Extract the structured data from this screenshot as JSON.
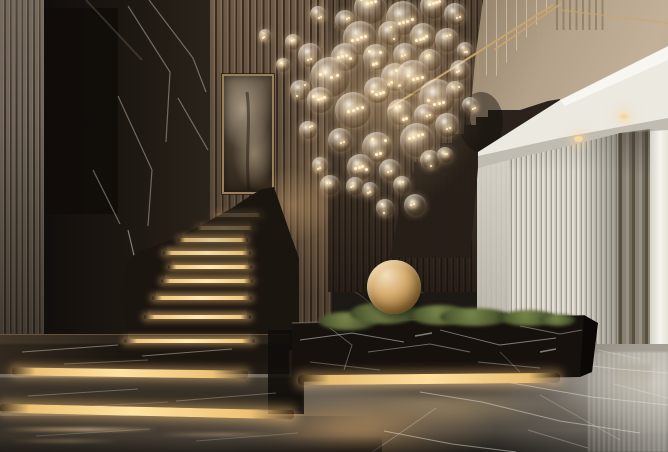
{
  "meta": {
    "description": "Luxury villa entrance hall: black marble feature wall, illuminated black-marble staircase with warm LED step nosings and glass balustrade, glass-bubble chandelier, beige upper landing with brass handrail, white curved soffit with recessed lights, white fluted wall, taupe curtain, indoor tree in a black marble planter with brass spheres and moss, polished grey marble floor. Semi-transparent real-estate watermark over the centre."
  },
  "watermark": {
    "number": "25",
    "brand": "SPACES",
    "tagline": "real estate",
    "color": "rgba(231,228,219,0.6)"
  },
  "palette": {
    "brass": "#c9a66a",
    "step_glow": "#ffe3a0",
    "dark_marble": "#1b1510",
    "wood_slat": "#7b6651",
    "beige_wall": "#b3a189",
    "soffit_white": "#ece9e1",
    "fluted_wall": "#d6d2c7",
    "curtain": "#857c6f",
    "floor_grey": "#6e6860",
    "foliage_green": "#64743e",
    "gold_sphere": "#d9b174"
  },
  "scene": {
    "chandelier": {
      "bubbles": [
        [
          370,
          8,
          16
        ],
        [
          403,
          18,
          17
        ],
        [
          433,
          6,
          13
        ],
        [
          455,
          14,
          11
        ],
        [
          345,
          20,
          10
        ],
        [
          318,
          14,
          8
        ],
        [
          360,
          38,
          17
        ],
        [
          390,
          33,
          12
        ],
        [
          423,
          36,
          13
        ],
        [
          447,
          40,
          12
        ],
        [
          465,
          50,
          8
        ],
        [
          293,
          42,
          8
        ],
        [
          310,
          55,
          12
        ],
        [
          345,
          57,
          14
        ],
        [
          376,
          57,
          13
        ],
        [
          405,
          55,
          12
        ],
        [
          430,
          60,
          11
        ],
        [
          460,
          70,
          10
        ],
        [
          283,
          65,
          7
        ],
        [
          265,
          35,
          6
        ],
        [
          330,
          77,
          20
        ],
        [
          395,
          77,
          14
        ],
        [
          413,
          77,
          17
        ],
        [
          300,
          90,
          10
        ],
        [
          377,
          90,
          13
        ],
        [
          455,
          90,
          9
        ],
        [
          437,
          97,
          18
        ],
        [
          320,
          100,
          13
        ],
        [
          470,
          105,
          8
        ],
        [
          353,
          110,
          18
        ],
        [
          400,
          112,
          13
        ],
        [
          425,
          115,
          11
        ],
        [
          308,
          130,
          9
        ],
        [
          340,
          140,
          12
        ],
        [
          417,
          140,
          17
        ],
        [
          447,
          125,
          12
        ],
        [
          445,
          155,
          8
        ],
        [
          377,
          147,
          15
        ],
        [
          360,
          167,
          13
        ],
        [
          430,
          160,
          10
        ],
        [
          390,
          170,
          11
        ],
        [
          402,
          185,
          9
        ],
        [
          370,
          190,
          8
        ],
        [
          330,
          185,
          10
        ],
        [
          320,
          165,
          8
        ],
        [
          415,
          205,
          11
        ],
        [
          385,
          208,
          9
        ],
        [
          355,
          186,
          9
        ]
      ]
    },
    "staircase": {
      "step_lights": [
        [
          212,
          50,
          215,
          0.22
        ],
        [
          196,
          58,
          228,
          0.35
        ],
        [
          178,
          70,
          240,
          0.85
        ],
        [
          163,
          88,
          253,
          0.95
        ],
        [
          168,
          84,
          267,
          1
        ],
        [
          161,
          92,
          281,
          1
        ],
        [
          152,
          100,
          298,
          1
        ],
        [
          144,
          107,
          317,
          1
        ],
        [
          124,
          131,
          341,
          1
        ]
      ]
    },
    "tree": {
      "foliage": [
        [
          328,
          200,
          56,
          46,
          0.9
        ],
        [
          362,
          178,
          64,
          50,
          0.92
        ],
        [
          402,
          170,
          58,
          44,
          0.9
        ],
        [
          355,
          225,
          70,
          55,
          0.95
        ],
        [
          398,
          215,
          66,
          52,
          0.95
        ],
        [
          432,
          200,
          56,
          46,
          0.9
        ],
        [
          430,
          245,
          72,
          56,
          0.95
        ],
        [
          378,
          258,
          66,
          50,
          0.95
        ],
        [
          330,
          248,
          52,
          44,
          0.9
        ],
        [
          462,
          232,
          52,
          46,
          0.88
        ],
        [
          472,
          270,
          50,
          56,
          0.9
        ],
        [
          418,
          280,
          60,
          40,
          0.92
        ],
        [
          300,
          232,
          40,
          36,
          0.8
        ],
        [
          448,
          160,
          40,
          32,
          0.72
        ],
        [
          490,
          252,
          36,
          44,
          0.8
        ],
        [
          508,
          282,
          30,
          38,
          0.7
        ],
        [
          350,
          152,
          34,
          28,
          0.55
        ],
        [
          385,
          142,
          28,
          24,
          0.5
        ]
      ]
    },
    "planter": {
      "moss": [
        [
          318,
          312,
          60,
          18
        ],
        [
          350,
          302,
          70,
          22
        ],
        [
          410,
          305,
          60,
          20
        ],
        [
          440,
          308,
          70,
          18
        ],
        [
          500,
          310,
          56,
          16
        ],
        [
          540,
          314,
          36,
          12
        ]
      ]
    }
  }
}
